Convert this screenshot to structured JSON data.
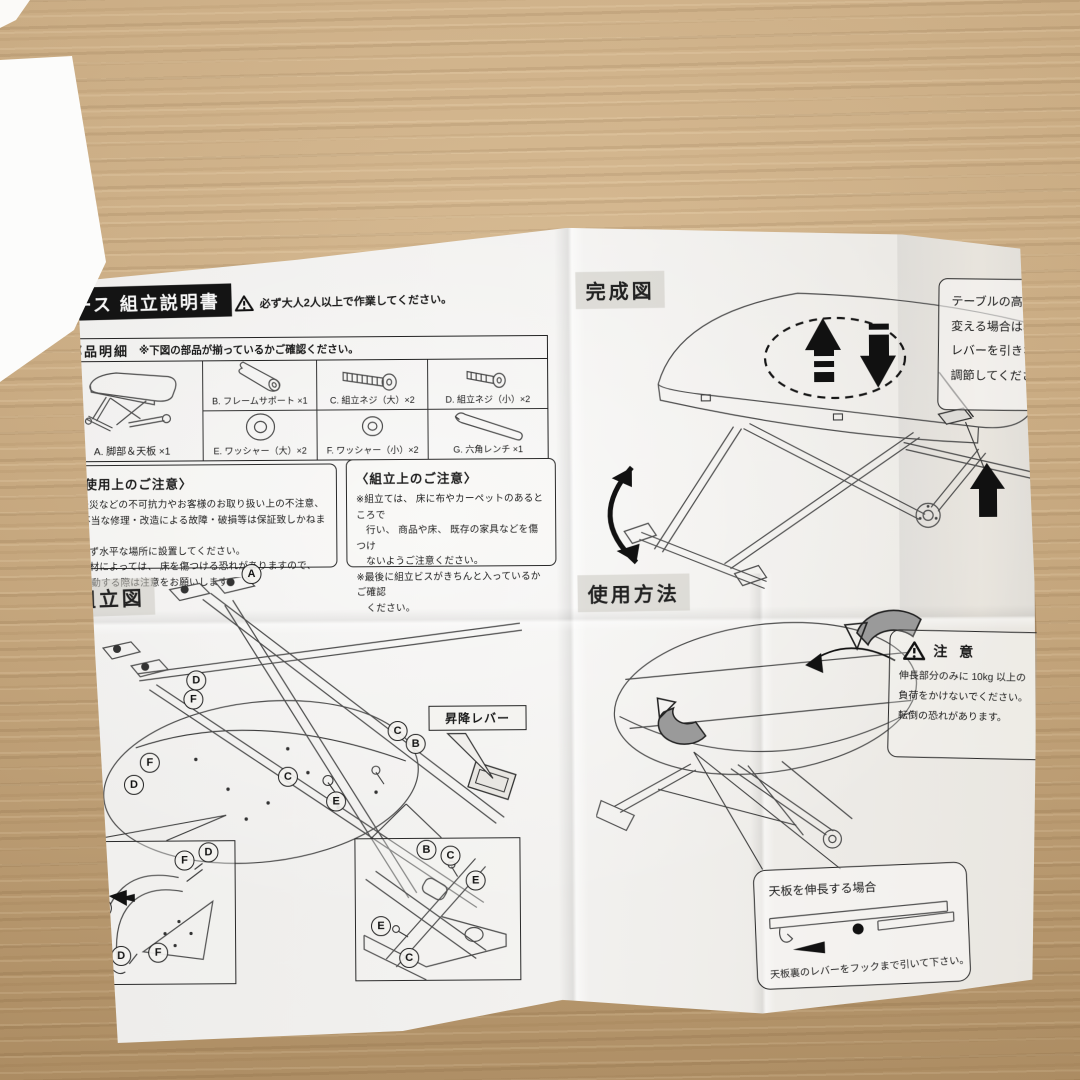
{
  "scene": {
    "description": "Japanese furniture assembly instruction sheet photographed on a wooden table",
    "wood_color": "#cbaa7e",
    "paper_color": "#f0efed",
    "ink_color": "#1b1b1b"
  },
  "sheet": {
    "header": {
      "title": "ース 組立説明書",
      "warning": "必ず大人2人以上で作業してください。"
    },
    "parts": {
      "title": "部品明細",
      "note": "※下図の部品が揃っているかご確認ください。",
      "items": [
        {
          "id": "A",
          "label": "A. 脚部＆天板 ×1",
          "icon": "table-frame-icon"
        },
        {
          "id": "B",
          "label": "B. フレームサポート ×1",
          "icon": "cylinder-icon"
        },
        {
          "id": "C",
          "label": "C. 組立ネジ（大）×2",
          "icon": "large-screw-icon"
        },
        {
          "id": "D",
          "label": "D. 組立ネジ（小）×2",
          "icon": "small-screw-icon"
        },
        {
          "id": "E",
          "label": "E. ワッシャー（大）×2",
          "icon": "large-washer-icon"
        },
        {
          "id": "F",
          "label": "F. ワッシャー（小）×2",
          "icon": "small-washer-icon"
        },
        {
          "id": "G",
          "label": "G. 六角レンチ ×1",
          "icon": "hex-wrench-icon"
        }
      ]
    },
    "usage_caution": {
      "title": "〈使用上のご注意〉",
      "lines": [
        "※天災などの不可抗力やお客様のお取り扱い上の不注意、",
        "　不当な修理・改造による故障・破損等は保証致しかねます。",
        "※必ず水平な場所に設置してください。",
        "※床材によっては、 床を傷つける恐れがありますので、",
        "　移動する際は注意をお願いします。"
      ]
    },
    "assembly_caution": {
      "title": "〈組立上のご注意〉",
      "lines": [
        "※組立ては、 床に布やカーペットのあるところで",
        "　行い、 商品や床、 既存の家具などを傷つけ",
        "　ないようご注意ください。",
        "※最後に組立ビスがきちんと入っているかご確認",
        "　ください。"
      ]
    },
    "assembly_figure": {
      "label": "組立図",
      "lever_tag": "昇降レバー",
      "letters": [
        "A",
        "B",
        "C",
        "D",
        "E",
        "F"
      ]
    },
    "completed_figure": {
      "label": "完成図",
      "bubble_lines": [
        "テーブルの高さを",
        "変える場合は、",
        "レバーを引きながら",
        "調節してください。"
      ]
    },
    "usage_figure": {
      "label": "使用方法",
      "caution_title": "注 意",
      "caution_lines": [
        "伸長部分のみに 10kg 以上の",
        "負荷をかけないでください。",
        "転倒の恐れがあります。"
      ],
      "extend_bubble": {
        "title": "天板を伸長する場合",
        "note": "天板裏のレバーをフックまで引いて下さい。"
      }
    }
  }
}
